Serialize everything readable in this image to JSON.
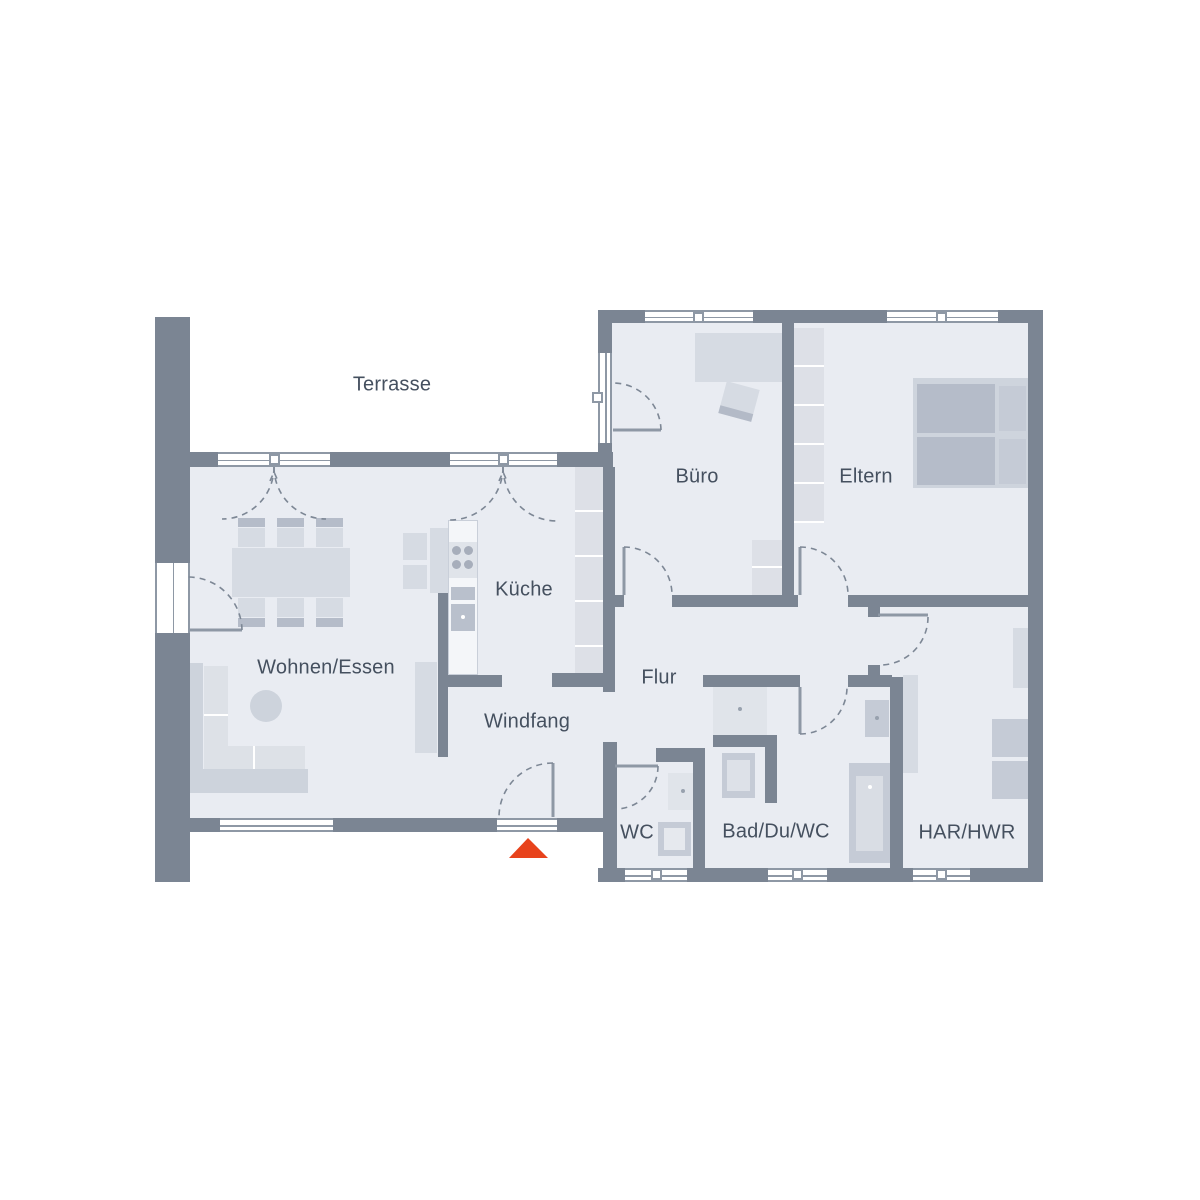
{
  "floorplan": {
    "rooms": {
      "terrasse": "Terrasse",
      "buero": "Büro",
      "eltern": "Eltern",
      "kueche": "Küche",
      "wohnen_essen": "Wohnen/Essen",
      "flur": "Flur",
      "windfang": "Windfang",
      "wc": "WC",
      "bad": "Bad/Du/WC",
      "har_hwr": "HAR/HWR"
    },
    "colors": {
      "wall": "#7b8593",
      "floor": "#e9ecf2",
      "furniture_light": "#d6dbe3",
      "furniture_mid": "#c5cbd6",
      "line": "#8e98a5",
      "line_arc": "#7d8795",
      "label_text": "#45505f",
      "accent_entrance": "#e8431c"
    }
  }
}
